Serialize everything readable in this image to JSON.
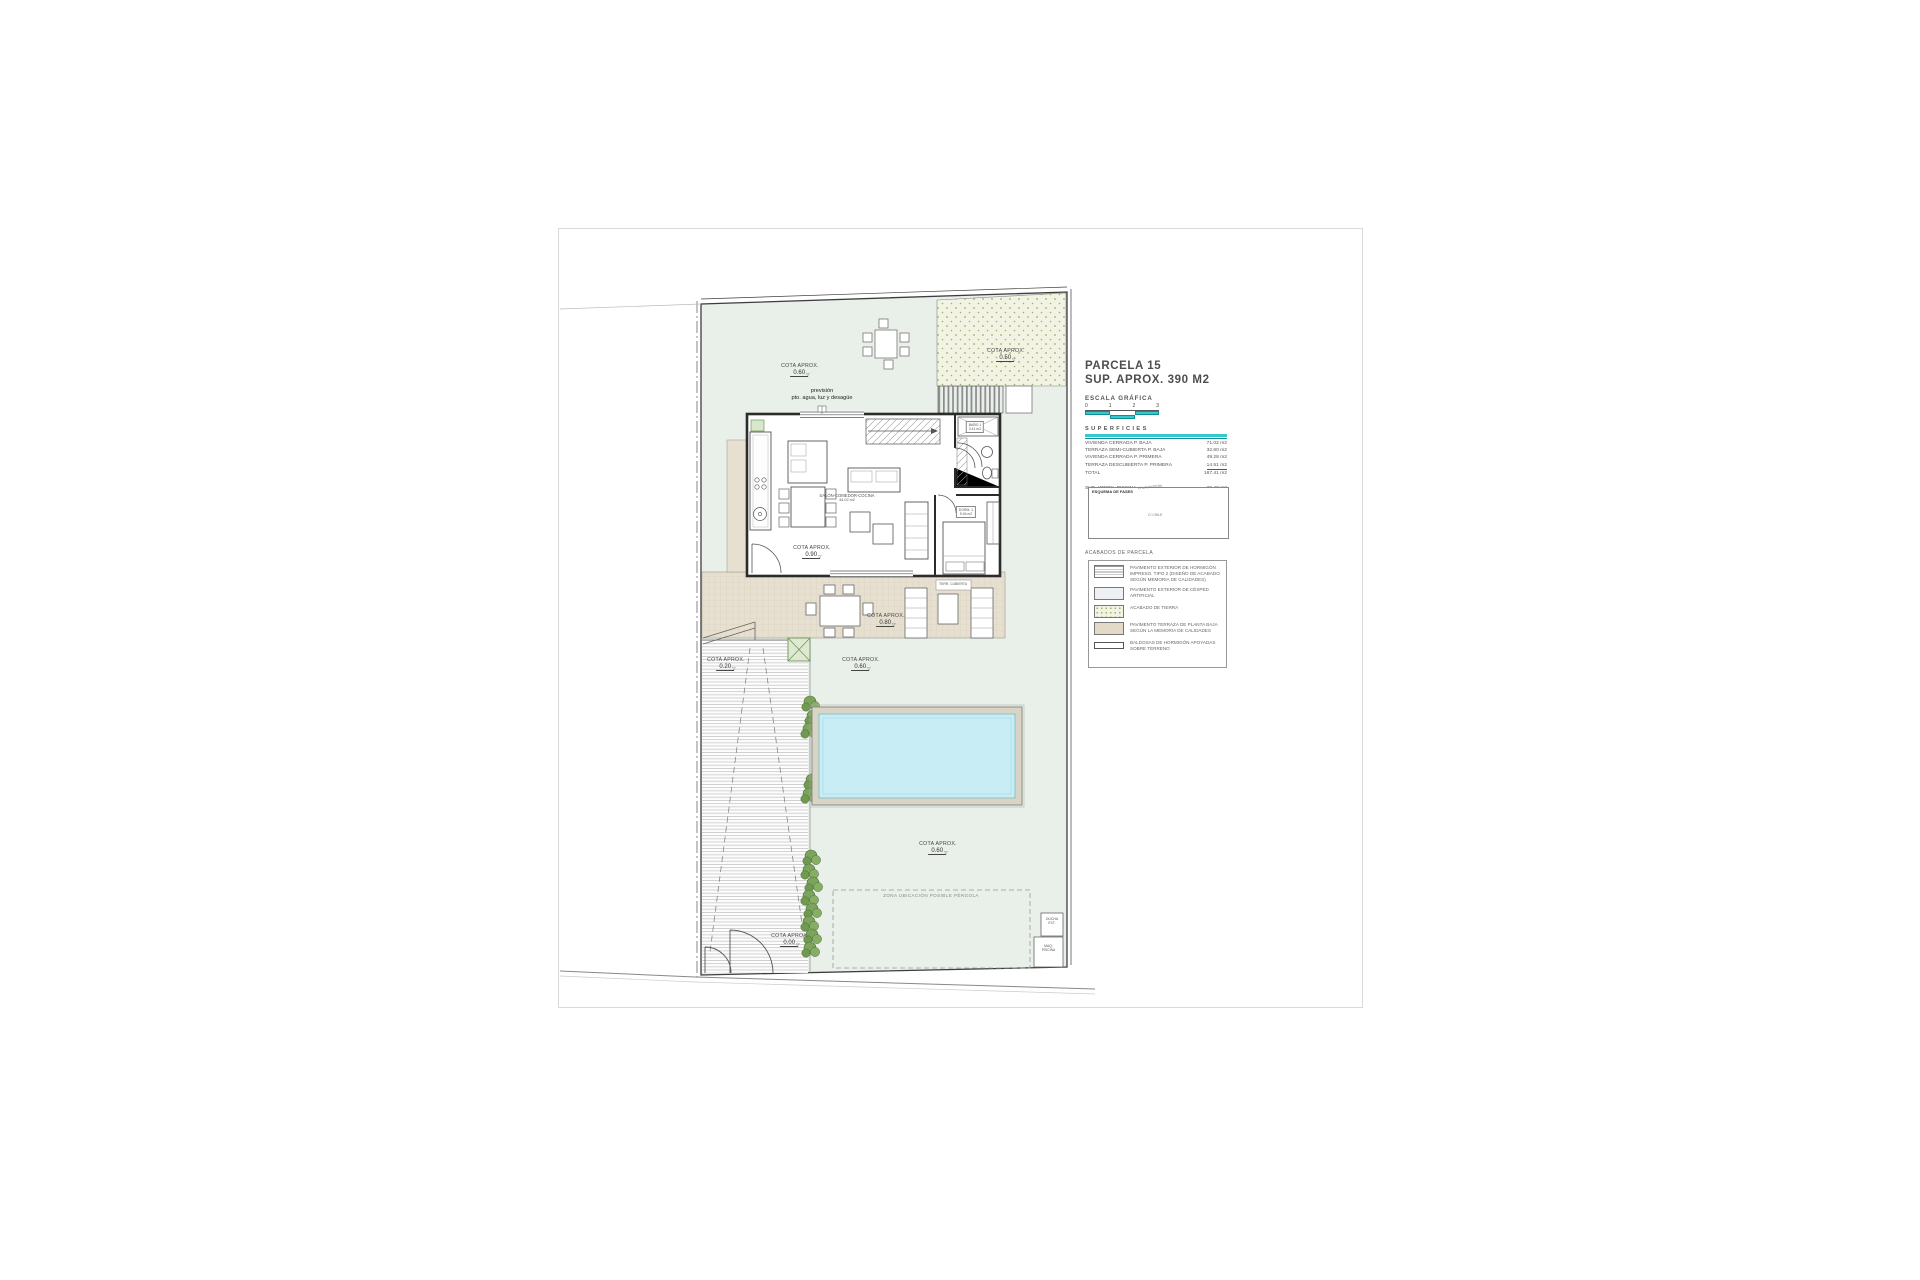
{
  "icons": {
    "level_marker": "▽",
    "north_arrow": "✛"
  },
  "colors": {
    "accent_cyan": "#35c9cd",
    "accent_teal_dark": "#128e96",
    "garden_green": "#e9efe9",
    "terrace_tan": "#e7e0d0",
    "pool_water": "#c9edf5",
    "hedge_green": "#7ca45c",
    "tierra_bg": "#f2f3e3"
  },
  "title_block": {
    "title": "PARCELA 15",
    "subtitle": "SUP. APROX. 390 M2",
    "scale_label": "ESCALA GRÁFICA",
    "scale_ticks": [
      "0",
      "1",
      "2",
      "3"
    ],
    "superficies": {
      "heading": "SUPERFICIES",
      "rows": [
        {
          "label": "VIVIENDA CERRADA P. BAJA",
          "value": "71.02 m2"
        },
        {
          "label": "TERRAZA SEMI-CUBIERTA P. BAJA",
          "value": "32.60 m2"
        },
        {
          "label": "VIVIENDA CERRADA P. PRIMERA",
          "value": "49.28 m2"
        },
        {
          "label": "TERRAZA DESCUBIERTA P. PRIMERA",
          "value": "14.51 m2"
        },
        {
          "label": "TOTAL",
          "value": "167.41 m2"
        }
      ],
      "pool_row": {
        "label": "SUP. APROX. PISCINA",
        "value": "26.40 m2"
      }
    },
    "minimap": {
      "title": "ESQUEMA DE FASES",
      "street_top": "C/ LAVANDERA",
      "street_bottom": "C/ CHILE"
    },
    "legend": {
      "heading": "ACABADOS DE PARCELA",
      "items": [
        {
          "label": "PAVIMENTO EXTERIOR DE HORMIGÓN IMPRESO. TIPO 2 (DISEÑO DE ACABADO SEGÚN MEMORIA DE CALIDADES)"
        },
        {
          "label": "PAVIMENTO EXTERIOR DE CÉSPED ARTIFICIAL"
        },
        {
          "label": "ACABADO DE TIERRA"
        },
        {
          "label": "PAVIMENTO TERRAZA DE PLANTA BAJA SEGÚN LA MEMORIA DE CALIDADES"
        },
        {
          "label": "BALDOSAS DE HORMIGÓN APOYADAS SOBRE TERRENO"
        }
      ]
    }
  },
  "plan": {
    "prevision": {
      "line1": "previsión",
      "line2": "pto. agua, luz y desagüe"
    },
    "cotas": [
      {
        "label": "COTA APROX.",
        "value": "0.60"
      },
      {
        "label": "COTA APROX.",
        "value": "0.50"
      },
      {
        "label": "COTA APROX.",
        "value": "0.90"
      },
      {
        "label": "COTA APROX.",
        "value": "0.80"
      },
      {
        "label": "COTA APROX.",
        "value": "0.20"
      },
      {
        "label": "COTA APROX.",
        "value": "0.60"
      },
      {
        "label": "COTA APROX.",
        "value": "0.60"
      },
      {
        "label": "COTA APROX.",
        "value": "0.00"
      }
    ],
    "rooms": {
      "salon": "SALÓN-COMEDOR-COCINA",
      "salon_area": "44.02 m2",
      "dorm": "DORM. 1",
      "dorm_area": "9.04 m2",
      "bano": "BAÑO 1",
      "bano_area": "3.41 m2",
      "terraza_cubierta": "TERR. CUBIERTA"
    },
    "pergola_zone": "ZONA UBICACIÓN POSIBLE PÉRGOLA",
    "ducha": {
      "line1": "DUCHA",
      "line2": "EXT."
    },
    "maq": {
      "line1": "MAQ.",
      "line2": "PISCINA"
    }
  }
}
